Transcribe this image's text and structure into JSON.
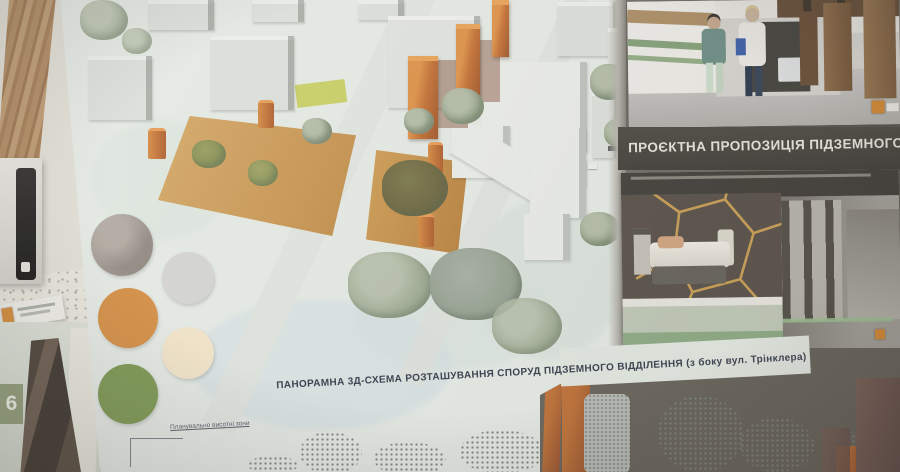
{
  "room": {
    "door_number": "6"
  },
  "poster": {
    "accent_orange": "#dd8a2e",
    "map": {
      "caption": "ПАНОРАМНА 3Д-СХЕМА РОЗТАШУВАННЯ СПОРУД ПІДЗЕМНОГО ВІДДІЛЕННЯ (з боку вул. Трінклера)",
      "annotation": "Планувально висотні зони",
      "palette": [
        {
          "name": "concrete-gray",
          "hex": "#a59d94"
        },
        {
          "name": "light-gray",
          "hex": "#d8d8d3"
        },
        {
          "name": "orange",
          "hex": "#dd8f3c"
        },
        {
          "name": "cream",
          "hex": "#f7e8ca"
        },
        {
          "name": "olive-green",
          "hex": "#7d9a4d"
        }
      ]
    },
    "right_column": {
      "heading": "ПРОЄКТНА ПРОПОЗИЦІЯ ПІДЗЕМНОГО"
    }
  }
}
